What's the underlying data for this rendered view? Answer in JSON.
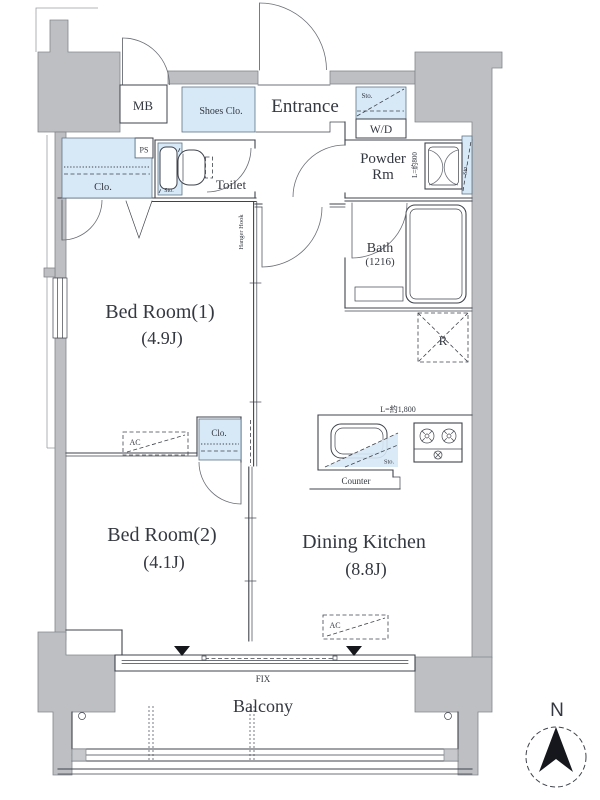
{
  "floor_plan": {
    "rooms": {
      "bedroom1": {
        "name": "Bed Room(1)",
        "size": "(4.9J)"
      },
      "bedroom2": {
        "name": "Bed Room(2)",
        "size": "(4.1J)"
      },
      "dining_kitchen": {
        "name": "Dining Kitchen",
        "size": "(8.8J)"
      },
      "entrance": {
        "name": "Entrance"
      },
      "toilet": {
        "name": "Toilet"
      },
      "powder_room": {
        "name_lines": [
          "Powder",
          "Rm"
        ]
      },
      "bath": {
        "name": "Bath",
        "size": "(1216)"
      },
      "balcony": {
        "name": "Balcony"
      }
    },
    "fixtures": {
      "meter_box": "MB",
      "shoes_closet": "Shoes Clo.",
      "washer_dryer": "W/D",
      "pipe_space": "PS",
      "closet": "Clo.",
      "storage": "Sto.",
      "hanger_hook": "Hanger Hook",
      "refrigerator": "R",
      "air_conditioner": "AC",
      "counter": "Counter",
      "fixed_window": "FIX"
    },
    "dimensions": {
      "kitchen_length": "L=約1,800",
      "vanity_length": "L=約800"
    },
    "compass": {
      "north": "N"
    },
    "colors": {
      "wall": "#bdbfc2",
      "fixture_fill": "#d7e8f6",
      "line": "#3f434c"
    }
  }
}
